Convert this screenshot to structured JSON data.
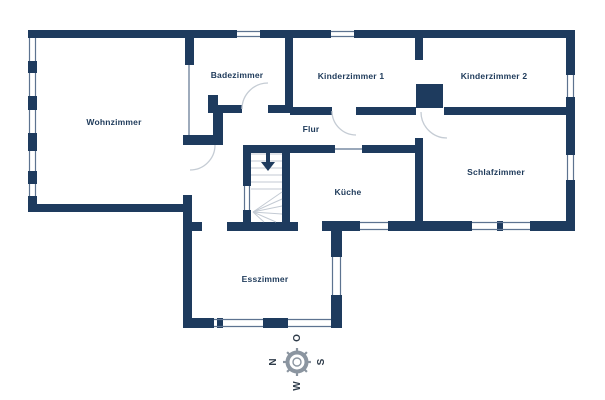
{
  "title": "Grundriss (floor plan)",
  "rooms": [
    {
      "label": "Wohnzimmer"
    },
    {
      "label": "Badezimmer"
    },
    {
      "label": "Kinderzimmer 1"
    },
    {
      "label": "Kinderzimmer 2"
    },
    {
      "label": "Flur"
    },
    {
      "label": "Küche"
    },
    {
      "label": "Schlafzimmer"
    },
    {
      "label": "Esszimmer"
    }
  ],
  "stairs": {
    "direction": "down-arrow"
  },
  "compass": {
    "n": "N",
    "o": "O",
    "s": "S",
    "w": "W"
  },
  "colors": {
    "wall": "#1e3b5e",
    "label": "#1e3a5a",
    "door_arc": "#c5ccd4",
    "stair_line": "#c3cad3",
    "window_line": "#5d7390",
    "compass": "#8b95a0",
    "background": "#ffffff"
  }
}
